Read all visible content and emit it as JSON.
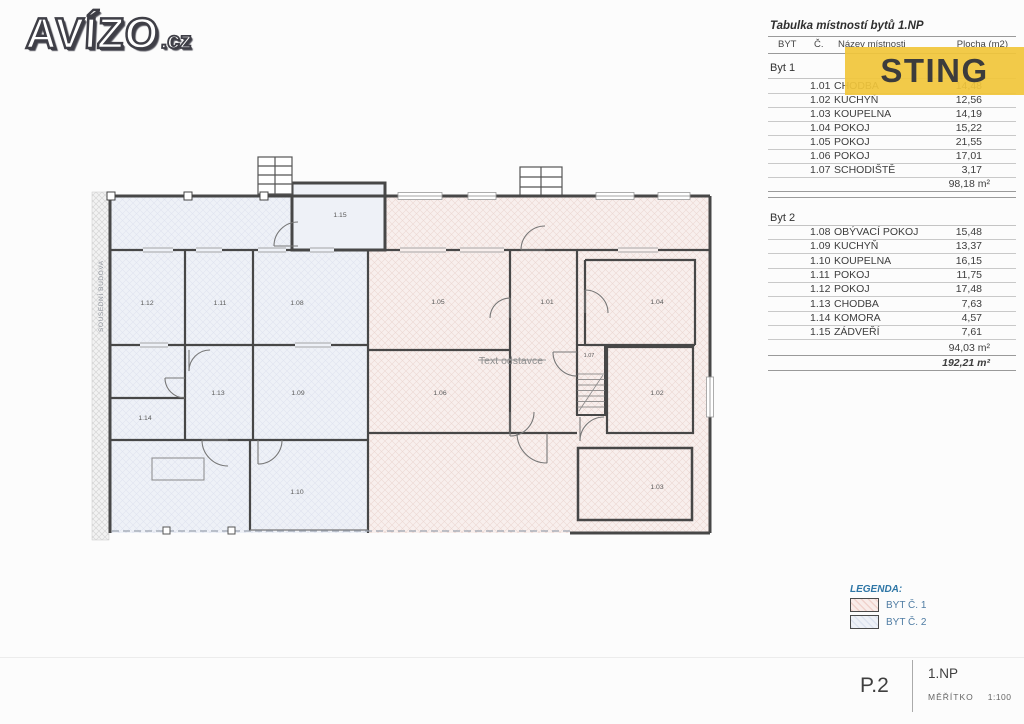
{
  "logo": {
    "brand": "AVÍZO",
    "tld": ".cz"
  },
  "badge": {
    "label": "STING",
    "bg": "#f1c639",
    "fg": "#3c3c3c"
  },
  "table": {
    "title": "Tabulka místností bytů 1.NP",
    "headers": {
      "byt": "BYT",
      "no": "Č.",
      "name": "Název místnosti",
      "area": "Plocha (m2)"
    },
    "byt1": {
      "label": "Byt 1",
      "rows": [
        {
          "no": "1.01",
          "name": "CHODBA",
          "area": "14,48"
        },
        {
          "no": "1.02",
          "name": "KUCHYŇ",
          "area": "12,56"
        },
        {
          "no": "1.03",
          "name": "KOUPELNA",
          "area": "14,19"
        },
        {
          "no": "1.04",
          "name": "POKOJ",
          "area": "15,22"
        },
        {
          "no": "1.05",
          "name": "POKOJ",
          "area": "21,55"
        },
        {
          "no": "1.06",
          "name": "POKOJ",
          "area": "17,01"
        },
        {
          "no": "1.07",
          "name": "SCHODIŠTĚ",
          "area": "3,17"
        }
      ],
      "subtotal": "98,18 m²"
    },
    "byt2": {
      "label": "Byt 2",
      "rows": [
        {
          "no": "1.08",
          "name": "OBÝVACÍ POKOJ",
          "area": "15,48"
        },
        {
          "no": "1.09",
          "name": "KUCHYŇ",
          "area": "13,37"
        },
        {
          "no": "1.10",
          "name": "KOUPELNA",
          "area": "16,15"
        },
        {
          "no": "1.11",
          "name": "POKOJ",
          "area": "11,75"
        },
        {
          "no": "1.12",
          "name": "POKOJ",
          "area": "17,48"
        },
        {
          "no": "1.13",
          "name": "CHODBA",
          "area": "7,63"
        },
        {
          "no": "1.14",
          "name": "KOMORA",
          "area": "4,57"
        },
        {
          "no": "1.15",
          "name": "ZÁDVEŘÍ",
          "area": "7,61"
        }
      ],
      "subtotal": "94,03 m²"
    },
    "total": "192,21 m²"
  },
  "plan": {
    "rooms": [
      "1.01",
      "1.02",
      "1.03",
      "1.04",
      "1.05",
      "1.06",
      "1.07",
      "1.08",
      "1.09",
      "1.10",
      "1.11",
      "1.12",
      "1.13",
      "1.14",
      "1.15"
    ],
    "neighbor_label": "SOUSEDNÍ BUDOVA",
    "paragraph_text": "Text odstavce",
    "colors": {
      "byt1_fill": "#f8efed",
      "byt2_fill": "#eef1f7",
      "wall": "#474747"
    }
  },
  "legend": {
    "title": "LEGENDA:",
    "items": [
      {
        "label": "BYT Č. 1",
        "color": "#f6e3df"
      },
      {
        "label": "BYT Č. 2",
        "color": "#e9edf5"
      }
    ]
  },
  "titleblock": {
    "sheet": "P.2",
    "floor": "1.NP",
    "scale_label": "MĚŘÍTKO",
    "scale_value": "1:100"
  }
}
